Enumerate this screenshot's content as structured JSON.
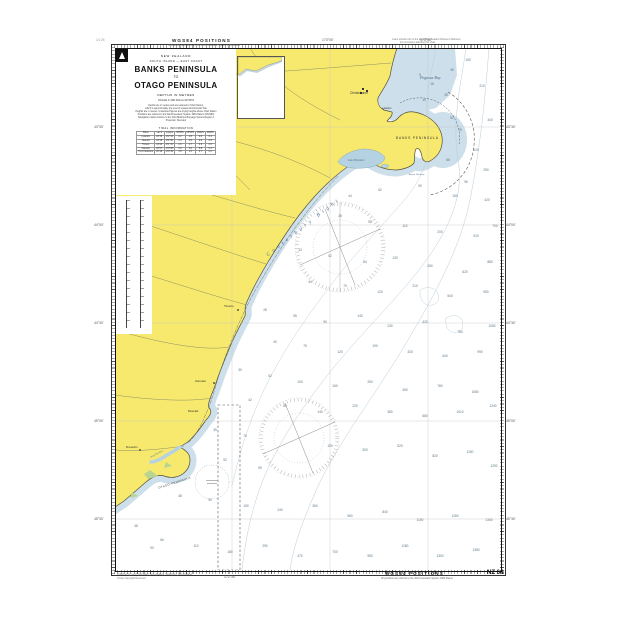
{
  "page": {
    "top_left_note": "14 26",
    "wgs_top": "WGS84 POSITIONS",
    "wgs_sub": "All positions are referred to the World Geodetic System 1984 Datum",
    "wgs_bottom": "WGS84 POSITIONS",
    "chart_number": "NZ 64",
    "top_right_line1": "Users should refer to the latest New Zealand Notices to Mariners",
    "top_right_line2": "for corrections affecting this chart",
    "bottom_left_line1": "Published by Land Information New Zealand, Wellington, New Zealand",
    "bottom_left_line2": "Crown Copyright Reserved"
  },
  "title_block": {
    "country": "NEW ZEALAND",
    "region": "SOUTH ISLAND — EAST COAST",
    "title_line1": "BANKS PENINSULA",
    "title_connector": "TO",
    "title_line2": "OTAGO PENINSULA",
    "depths": "DEPTHS IN METRES",
    "scale": "SCALE 1:300 000 at 44°30'S",
    "notes": [
      "Depths are in metres and are reduced to Chart Datum,",
      "which is approximately the level of Lowest Astronomical Tide",
      "Heights are in metres. Underlined figures are drying heights above Chart Datum",
      "Positions are referred to the World Geodetic System 1984 Datum (WGS84)",
      "Navigation marks conform to the IALA Maritime Buoyage System Region A",
      "Projection: Mercator"
    ],
    "tide_table": {
      "title": "TIDAL INFORMATION",
      "headers": [
        "Place",
        "Lat S",
        "Long E",
        "MHWS",
        "MHWN",
        "MLWN",
        "MLWS"
      ],
      "rows": [
        [
          "Lyttelton",
          "43°36'",
          "172°43'",
          "2.2",
          "1.8",
          "0.8",
          "0.4"
        ],
        [
          "Akaroa",
          "43°49'",
          "172°56'",
          "2.4",
          "1.9",
          "0.9",
          "0.5"
        ],
        [
          "Timaru",
          "44°24'",
          "171°15'",
          "2.0",
          "1.7",
          "0.9",
          "0.5"
        ],
        [
          "Oamaru",
          "45°07'",
          "170°58'",
          "1.9",
          "1.6",
          "0.8",
          "0.4"
        ],
        [
          "Port Chalmers",
          "45°49'",
          "170°39'",
          "1.8",
          "1.5",
          "0.7",
          "0.3"
        ]
      ]
    }
  },
  "graticule": {
    "lats": [
      {
        "t": "43°30'",
        "y": 127
      },
      {
        "t": "44°00'",
        "y": 225
      },
      {
        "t": "44°30'",
        "y": 323
      },
      {
        "t": "45°00'",
        "y": 421
      },
      {
        "t": "45°30'",
        "y": 519
      }
    ],
    "lons": [
      {
        "t": "172°30'",
        "x": 232
      },
      {
        "t": "173°00'",
        "x": 330
      },
      {
        "t": "173°30'",
        "x": 428
      }
    ]
  },
  "labels": [
    {
      "key": "pegasus-bay",
      "text": "Pegasus Bay",
      "x": 420,
      "y": 76,
      "s": 4,
      "i": 1,
      "c": "#4a6a8a"
    },
    {
      "key": "christchurch",
      "text": "Christchurch",
      "x": 350,
      "y": 92,
      "s": 3.2,
      "c": "#333"
    },
    {
      "key": "lyttelton",
      "text": "Lyttelton",
      "x": 382,
      "y": 108,
      "s": 2.5,
      "c": "#333"
    },
    {
      "key": "banks-peninsula",
      "text": "BANKS  PENINSULA",
      "x": 396,
      "y": 137,
      "s": 3.3,
      "c": "#333",
      "ls": 0.8
    },
    {
      "key": "akaroa-harbour",
      "text": "Akaroa Harbour",
      "x": 408,
      "y": 174,
      "s": 2.5,
      "i": 1,
      "c": "#4a6a8a"
    },
    {
      "key": "lake-ellesmere",
      "text": "Lake Ellesmere",
      "x": 348,
      "y": 160,
      "s": 2.7,
      "i": 1,
      "c": "#4a6a8a"
    },
    {
      "key": "canterbury-bight",
      "text": "Canterbury Bight",
      "x": 266,
      "y": 254,
      "s": 5.2,
      "i": 1,
      "c": "#4a6a8a",
      "rot": -38,
      "ls": 3.5
    },
    {
      "key": "timaru",
      "text": "Timaru",
      "x": 224,
      "y": 305,
      "s": 3.1,
      "c": "#333"
    },
    {
      "key": "oamaru",
      "text": "Oamaru",
      "x": 195,
      "y": 380,
      "s": 3.1,
      "c": "#333"
    },
    {
      "key": "moeraki",
      "text": "Moeraki",
      "x": 188,
      "y": 410,
      "s": 2.9,
      "c": "#333"
    },
    {
      "key": "otago-peninsula",
      "text": "OTAGO PENINSULA",
      "x": 158,
      "y": 487,
      "s": 2.8,
      "c": "#333",
      "rot": -18,
      "ls": 0.5
    },
    {
      "key": "dunedin",
      "text": "Dunedin",
      "x": 126,
      "y": 446,
      "s": 3.1,
      "c": "#333"
    },
    {
      "key": "otago-harbour",
      "text": "Otago Harbour",
      "x": 150,
      "y": 457,
      "s": 2.3,
      "i": 1,
      "c": "#4a6a8a",
      "rot": -28
    }
  ],
  "soundings": [
    [
      420,
      75,
      9
    ],
    [
      432,
      84,
      16
    ],
    [
      446,
      95,
      28
    ],
    [
      424,
      100,
      14
    ],
    [
      452,
      70,
      45
    ],
    [
      468,
      60,
      150
    ],
    [
      482,
      86,
      210
    ],
    [
      460,
      130,
      75
    ],
    [
      476,
      150,
      120
    ],
    [
      490,
      120,
      340
    ],
    [
      486,
      170,
      250
    ],
    [
      466,
      182,
      96
    ],
    [
      452,
      118,
      52
    ],
    [
      448,
      160,
      66
    ],
    [
      350,
      196,
      44
    ],
    [
      380,
      190,
      62
    ],
    [
      420,
      186,
      90
    ],
    [
      455,
      196,
      160
    ],
    [
      487,
      200,
      420
    ],
    [
      340,
      216,
      38
    ],
    [
      370,
      222,
      58
    ],
    [
      405,
      226,
      110
    ],
    [
      440,
      232,
      200
    ],
    [
      476,
      236,
      510
    ],
    [
      495,
      226,
      700
    ],
    [
      300,
      250,
      33
    ],
    [
      330,
      256,
      52
    ],
    [
      365,
      262,
      84
    ],
    [
      395,
      258,
      130
    ],
    [
      430,
      266,
      260
    ],
    [
      465,
      272,
      620
    ],
    [
      490,
      262,
      880
    ],
    [
      310,
      282,
      44
    ],
    [
      345,
      286,
      70
    ],
    [
      380,
      292,
      120
    ],
    [
      415,
      286,
      210
    ],
    [
      450,
      296,
      540
    ],
    [
      486,
      292,
      950
    ],
    [
      265,
      310,
      28
    ],
    [
      295,
      316,
      55
    ],
    [
      325,
      322,
      90
    ],
    [
      360,
      316,
      140
    ],
    [
      390,
      326,
      230
    ],
    [
      425,
      322,
      420
    ],
    [
      460,
      332,
      780
    ],
    [
      492,
      326,
      1050
    ],
    [
      275,
      342,
      40
    ],
    [
      305,
      346,
      75
    ],
    [
      340,
      352,
      120
    ],
    [
      375,
      346,
      190
    ],
    [
      410,
      352,
      330
    ],
    [
      445,
      356,
      640
    ],
    [
      480,
      352,
      990
    ],
    [
      240,
      370,
      30
    ],
    [
      270,
      376,
      62
    ],
    [
      300,
      382,
      100
    ],
    [
      335,
      386,
      160
    ],
    [
      370,
      382,
      260
    ],
    [
      405,
      390,
      450
    ],
    [
      440,
      386,
      760
    ],
    [
      475,
      392,
      1080
    ],
    [
      250,
      400,
      42
    ],
    [
      285,
      406,
      85
    ],
    [
      320,
      412,
      140
    ],
    [
      355,
      406,
      220
    ],
    [
      390,
      412,
      380
    ],
    [
      425,
      416,
      680
    ],
    [
      460,
      412,
      1010
    ],
    [
      493,
      406,
      1240
    ],
    [
      215,
      430,
      35
    ],
    [
      245,
      436,
      70
    ],
    [
      330,
      446,
      190
    ],
    [
      365,
      450,
      300
    ],
    [
      400,
      446,
      520
    ],
    [
      435,
      456,
      820
    ],
    [
      470,
      452,
      1150
    ],
    [
      494,
      466,
      1290
    ],
    [
      260,
      468,
      95
    ],
    [
      225,
      460,
      52
    ],
    [
      180,
      496,
      48
    ],
    [
      210,
      500,
      90
    ],
    [
      246,
      506,
      150
    ],
    [
      280,
      510,
      240
    ],
    [
      315,
      506,
      360
    ],
    [
      350,
      516,
      560
    ],
    [
      385,
      512,
      840
    ],
    [
      420,
      520,
      1100
    ],
    [
      455,
      516,
      1260
    ],
    [
      489,
      520,
      1340
    ],
    [
      136,
      526,
      48
    ],
    [
      152,
      548,
      90
    ],
    [
      162,
      540,
      66
    ],
    [
      196,
      546,
      110
    ],
    [
      230,
      552,
      180
    ],
    [
      265,
      546,
      290
    ],
    [
      300,
      556,
      470
    ],
    [
      335,
      552,
      700
    ],
    [
      370,
      556,
      950
    ],
    [
      405,
      546,
      1180
    ],
    [
      440,
      556,
      1300
    ],
    [
      476,
      550,
      1380
    ]
  ],
  "colors": {
    "land": "#f6e96d",
    "shallow_water": "#ccdfea",
    "lake": "#b5d2e3",
    "contour": "#b9cdd8",
    "sounding_text": "#5b7585"
  }
}
